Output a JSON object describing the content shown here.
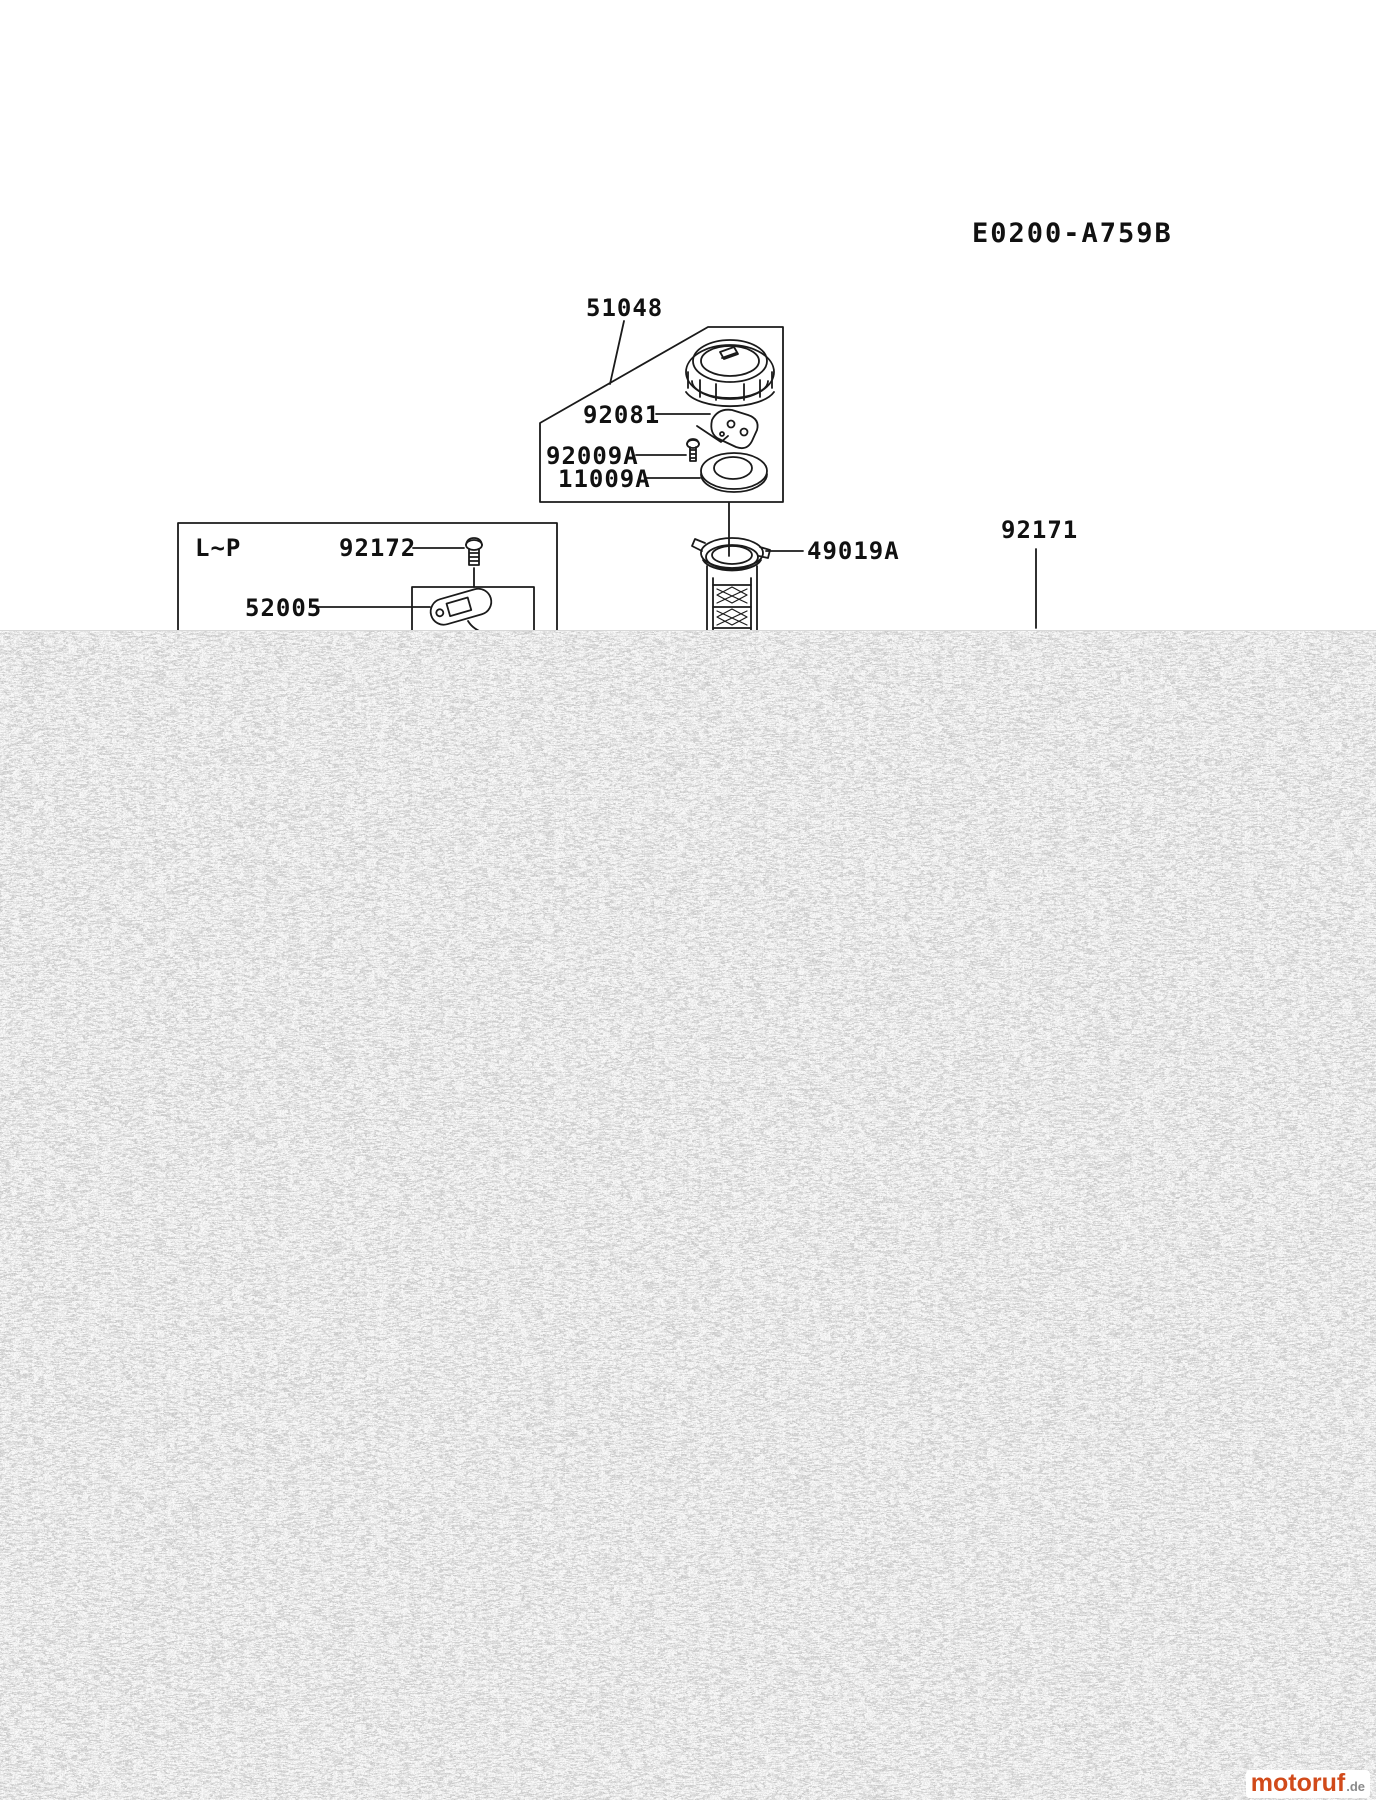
{
  "title": "E0200-A759B",
  "diagram": {
    "labels": {
      "fuel_cap": "51048",
      "cap_gasket": "92081",
      "cap_screw": "92009A",
      "cap_washer": "11009A",
      "spec_range": "L~P",
      "gauge_screw": "92172",
      "fuel_gauge": "52005",
      "fuel_strainer": "49019A",
      "fuel_tank": "92171"
    }
  },
  "watermark": {
    "brand": "motoruf",
    "tld": ".de",
    "brand_color": "#d14a1a"
  },
  "colors": {
    "line": "#1a1a1a",
    "noise_base": "#efefef"
  }
}
